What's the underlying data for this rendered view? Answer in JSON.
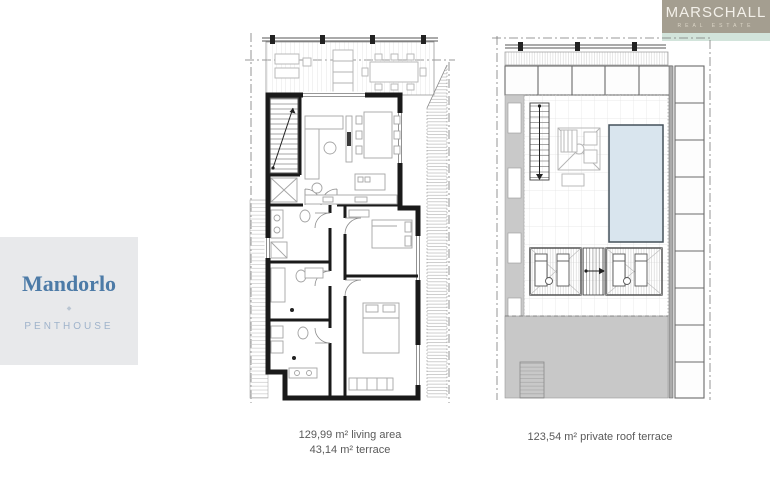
{
  "logo": {
    "name": "MARSCHALL",
    "tagline": "REAL ESTATE"
  },
  "unit": {
    "name": "Mandorlo",
    "separator": "◆",
    "type": "PENTHOUSE"
  },
  "plans": {
    "penthouse": {
      "caption_line1": "129,99 m² living area",
      "caption_line2": "43,14 m² terrace"
    },
    "roof": {
      "caption": "123,54 m² private roof terrace"
    }
  },
  "colors": {
    "brand_taupe": "#a49e90",
    "accent_mint": "#d2e4db",
    "card_background": "#e8e9eb",
    "unit_name_blue": "#4d7ba7",
    "unit_type_blue": "#9fb3cb",
    "caption_gray": "#5a5a5a",
    "wall_black": "#1a1a1a",
    "pool_blue": "#d9e5ee",
    "roof_gray": "#c8c8c8"
  }
}
